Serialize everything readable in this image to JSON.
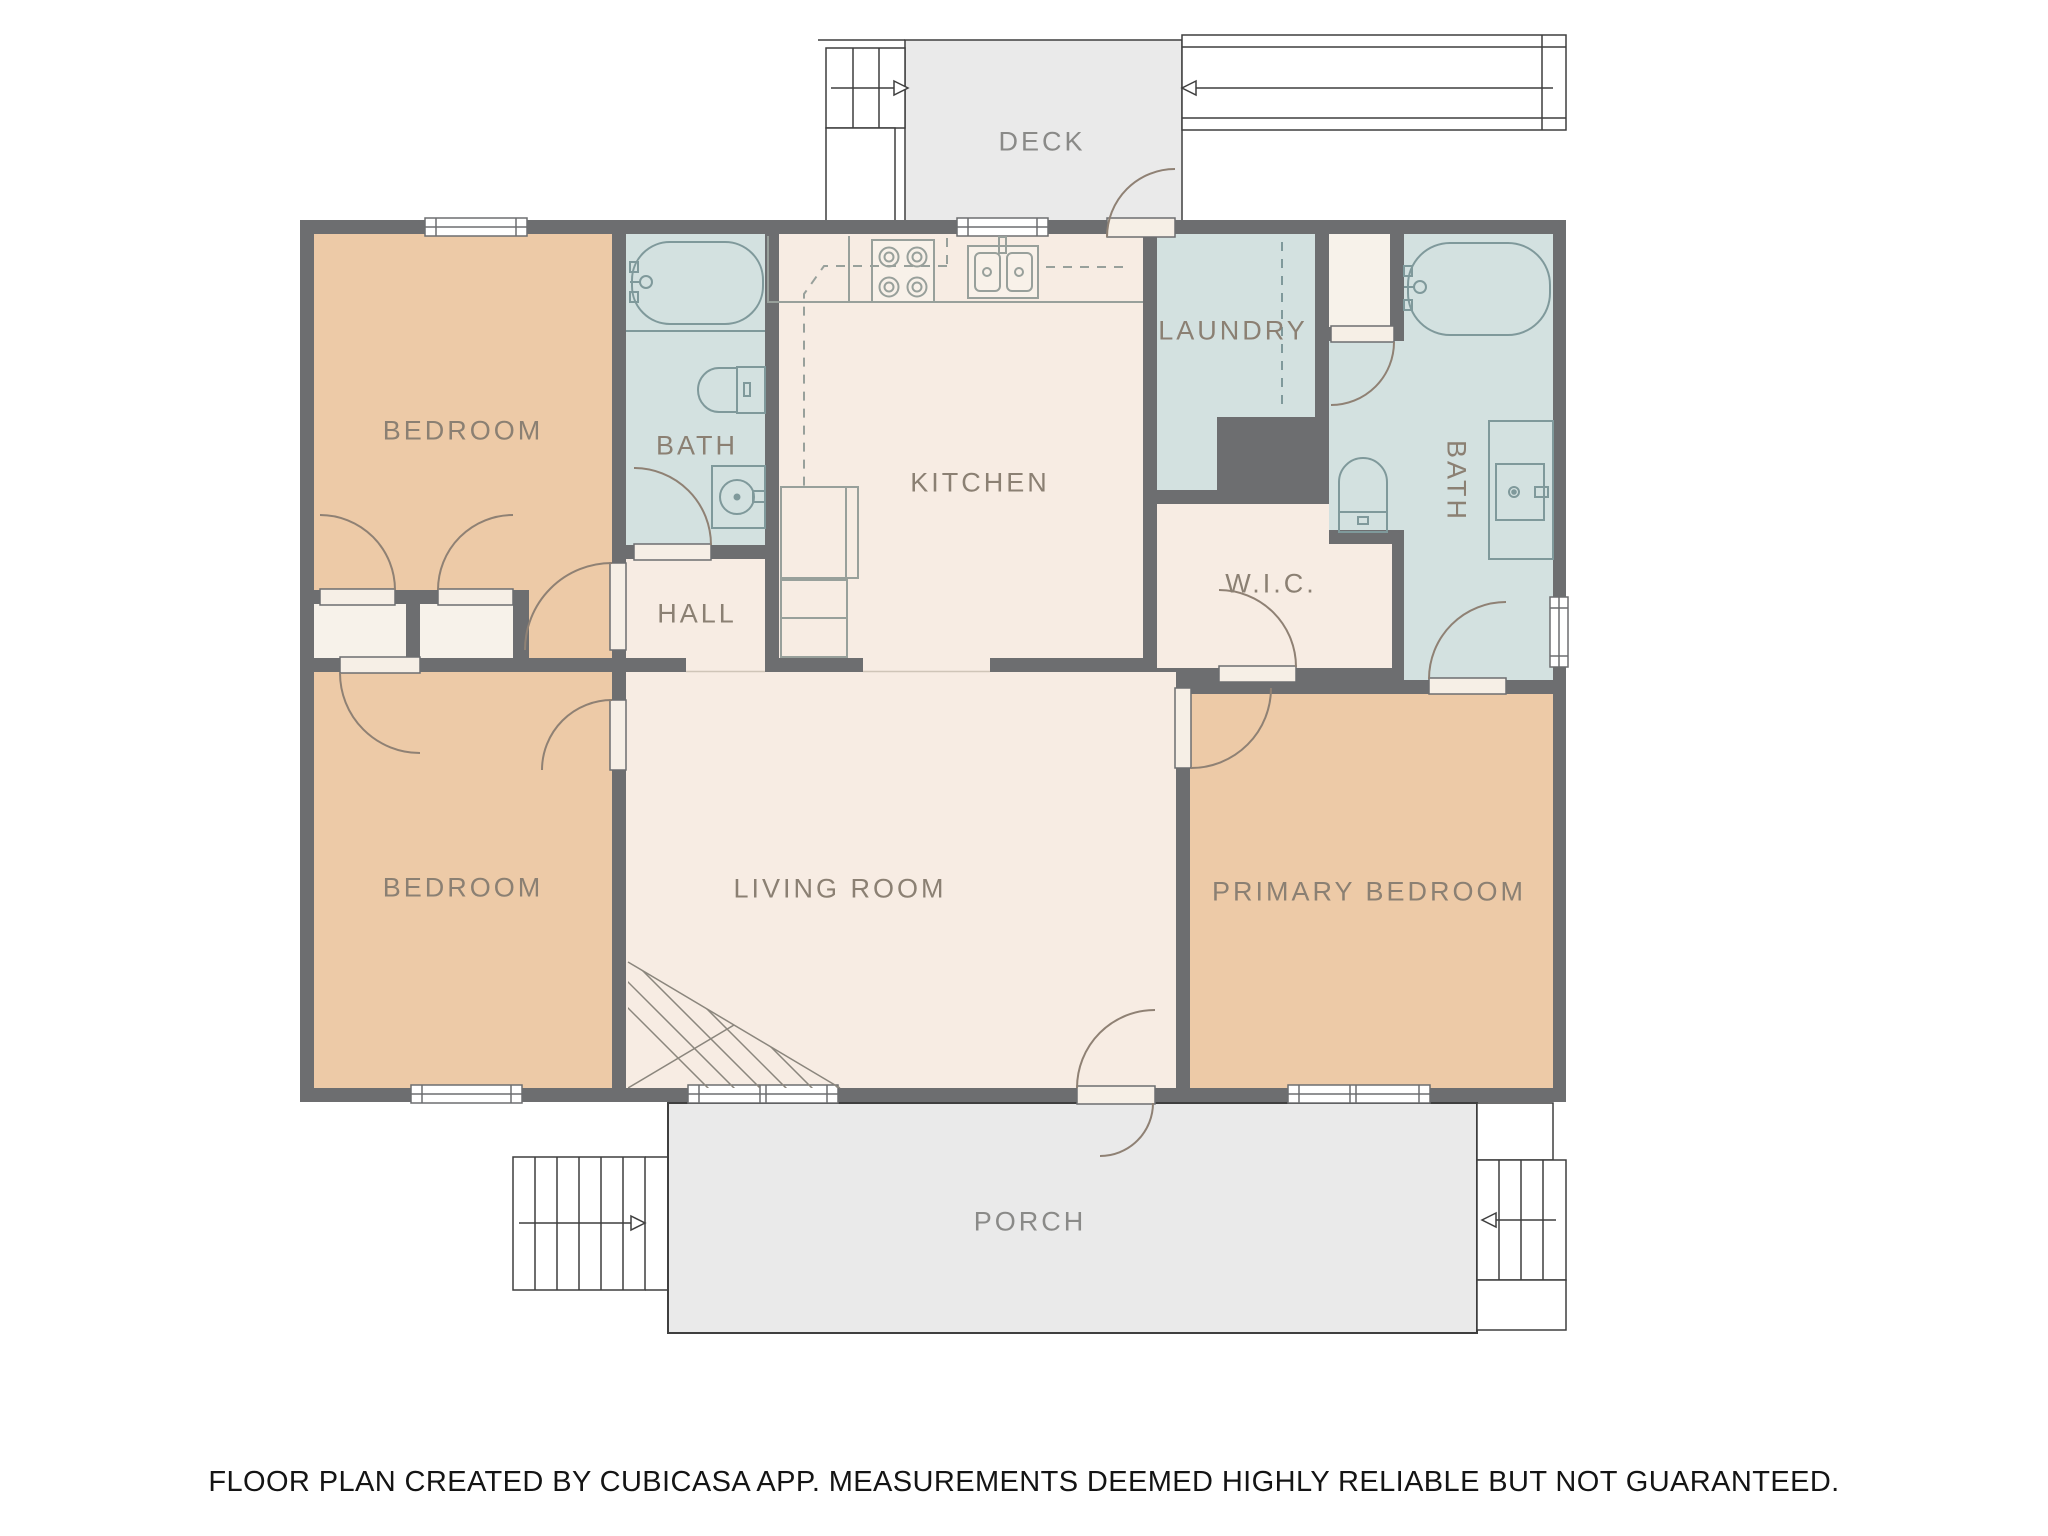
{
  "floor_plan": {
    "rooms": {
      "deck": {
        "label": "DECK"
      },
      "bedroom_top": {
        "label": "BEDROOM"
      },
      "bath_main": {
        "label": "BATH"
      },
      "kitchen": {
        "label": "KITCHEN"
      },
      "laundry": {
        "label": "LAUNDRY"
      },
      "bath_ensuite": {
        "label": "BATH"
      },
      "hall": {
        "label": "HALL"
      },
      "wic": {
        "label": "W.I.C."
      },
      "bedroom_bottom": {
        "label": "BEDROOM"
      },
      "living_room": {
        "label": "LIVING ROOM"
      },
      "primary_bedroom": {
        "label": "PRIMARY BEDROOM"
      },
      "porch": {
        "label": "PORCH"
      }
    },
    "fixtures": [
      "bathtub",
      "toilet",
      "sink",
      "vanity-sink",
      "stove",
      "kitchen-sink",
      "counter",
      "upper-cabinets-dashed",
      "washer-dryer-space",
      "basement-stairs-hatch"
    ],
    "arrows": [
      {
        "name": "deck-stairs-arrow",
        "direction": "right"
      },
      {
        "name": "walkway-arrow",
        "direction": "left"
      },
      {
        "name": "porch-left-stairs-arrow",
        "direction": "right"
      },
      {
        "name": "porch-right-stairs-arrow",
        "direction": "left"
      }
    ],
    "colors": {
      "wall": "#6d6e70",
      "bedroom_fill": "#edcaa7",
      "wet_room_fill": "#d3e1e0",
      "common_fill": "#f7ece3",
      "closet_fill": "#f7f2ea",
      "outdoor_fill": "#eaeaea",
      "label_text": "#8b8073",
      "fixture_line": "#7f999b",
      "door_arc": "#8f8174",
      "outline": "#3f3f3f"
    }
  },
  "footer": {
    "disclaimer": "FLOOR PLAN CREATED BY CUBICASA APP. MEASUREMENTS DEEMED HIGHLY RELIABLE BUT NOT GUARANTEED."
  }
}
